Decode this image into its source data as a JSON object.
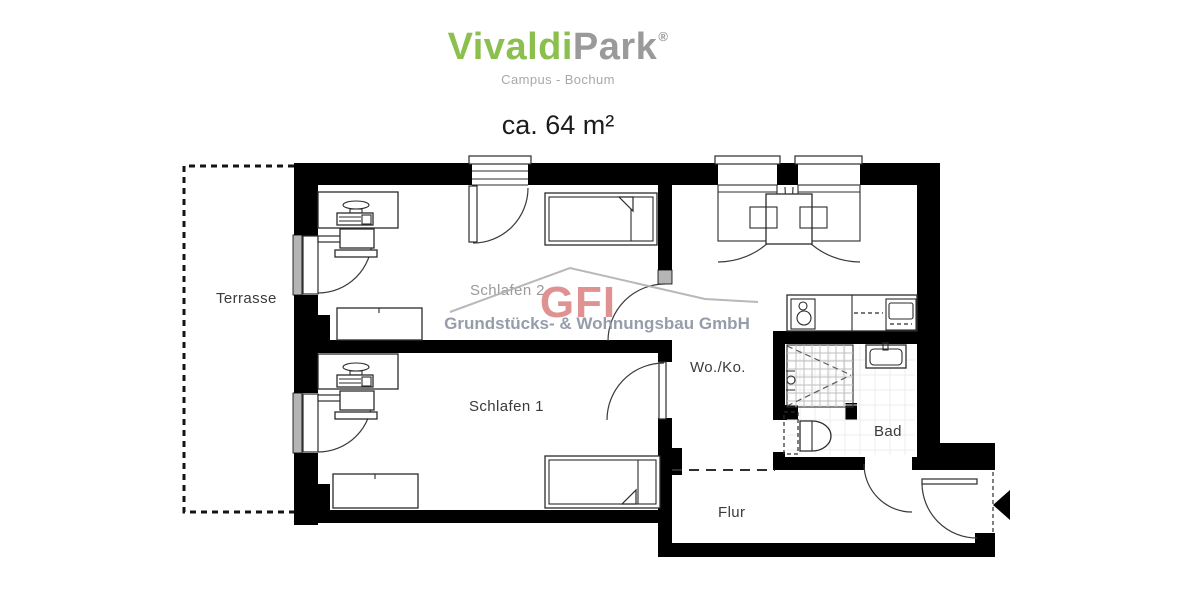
{
  "header": {
    "brand_part1": "Vivaldi",
    "brand_part2": "Park",
    "registered": "®",
    "subtitle": "Campus - Bochum",
    "area": "ca. 64 m²"
  },
  "rooms": {
    "terrasse": "Terrasse",
    "schlafen2": "Schlafen 2",
    "schlafen1": "Schlafen 1",
    "woko": "Wo./Ko.",
    "bad": "Bad",
    "flur": "Flur"
  },
  "watermark": {
    "logo": "GFI",
    "company": "Grundstücks- & Wohnungsbau GmbH"
  },
  "colors": {
    "brand_green": "#8cc04e",
    "brand_gray": "#9a9a9a",
    "watermark_red": "#db7e7e",
    "watermark_gray": "#8d95a3",
    "wall": "#000000"
  }
}
